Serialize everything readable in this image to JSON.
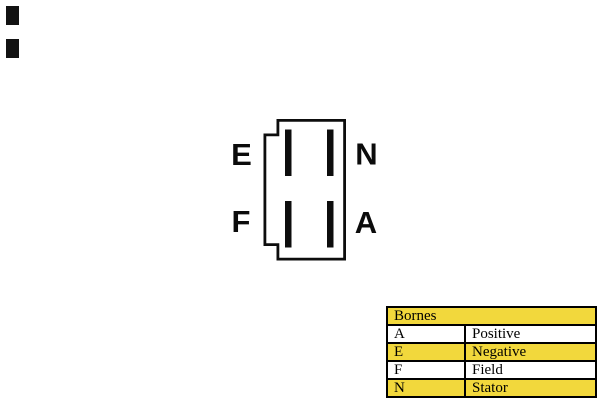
{
  "page": {
    "background_color": "#ffffff"
  },
  "connector_diagram": {
    "outline_color": "#0d0d0d",
    "pin_color": "#0d0d0d",
    "terminals": [
      {
        "label": "E",
        "position": "top-left"
      },
      {
        "label": "N",
        "position": "top-right"
      },
      {
        "label": "F",
        "position": "bottom-left"
      },
      {
        "label": "A",
        "position": "bottom-right"
      }
    ]
  },
  "legend_table": {
    "header": "Bornes",
    "rows": [
      {
        "terminal": "A",
        "description": "Positive",
        "highlighted": false
      },
      {
        "terminal": "E",
        "description": "Negative",
        "highlighted": true
      },
      {
        "terminal": "F",
        "description": "Field",
        "highlighted": false
      },
      {
        "terminal": "N",
        "description": "Stator",
        "highlighted": true
      }
    ],
    "highlight_color": "#F2D83C",
    "border_color": "#000000",
    "text_color": "#000000"
  }
}
